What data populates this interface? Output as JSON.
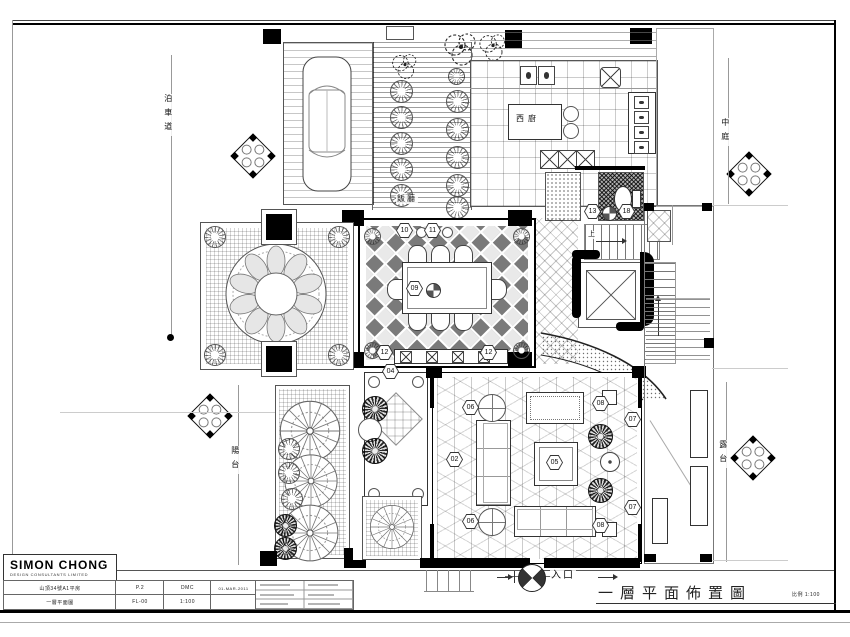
{
  "drawing_title": {
    "text": "一層平面佈置圖",
    "scale_note": "比例 1:100"
  },
  "entrance_label": "入口",
  "rooms": {
    "driveway": "泊車道",
    "dining": "飯廳",
    "kitchen": "西廚",
    "courtyard": "中庭",
    "balcony": "陽台",
    "terrace": "露台",
    "stair_up": "上"
  },
  "markers": {
    "m02": "02",
    "m04": "04",
    "m05": "05",
    "m06": "06",
    "m07": "07",
    "m08": "08",
    "m09": "09",
    "m10": "10",
    "m11": "11",
    "m12": "12",
    "m13": "13",
    "m18": "18"
  },
  "titleblock": {
    "company": "SIMON CHONG",
    "company_sub": "DESIGN CONSULTANTS LIMITED",
    "project_name": "山頂34號A1平房",
    "drawing_name": "一層平面圖",
    "sheet_no": "P.2",
    "drawing_no": "FL-00",
    "drawn_by": "DMC",
    "scale": "1:100",
    "date": "01-MAR-2011"
  }
}
